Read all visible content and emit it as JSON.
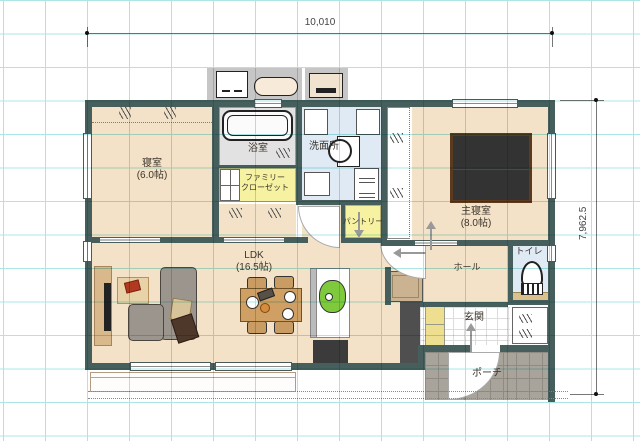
{
  "dims": {
    "top": "10,010",
    "right": "7,962.5"
  },
  "rooms": {
    "bedroom": {
      "name": "寝室",
      "size": "(6.0帖)"
    },
    "bath": {
      "name": "浴室"
    },
    "washroom": {
      "name": "洗面所"
    },
    "family_closet": {
      "line1": "ファミリー",
      "line2": "クローゼット"
    },
    "master": {
      "name": "主寝室",
      "size": "(8.0帖)"
    },
    "pantry": {
      "name": "パントリー"
    },
    "ldk": {
      "name": "LDK",
      "size": "(16.5帖)"
    },
    "hall": {
      "name": "ホール"
    },
    "toilet": {
      "name": "トイレ"
    },
    "entrance": {
      "name": "玄関"
    },
    "porch": {
      "name": "ポーチ"
    }
  },
  "colors": {
    "wall": "#465f5d",
    "floor_beige": "#f3e2c7",
    "closet_yellow": "#f6f2a2",
    "wet_area_blue": "#dfeaf5",
    "bath_gray": "#e2e2e2",
    "porch_gray": "#a8a49b",
    "grid_cyan": "#ace5e5",
    "kitchen_green": "#7ec93c",
    "bed_dark": "#333333"
  }
}
